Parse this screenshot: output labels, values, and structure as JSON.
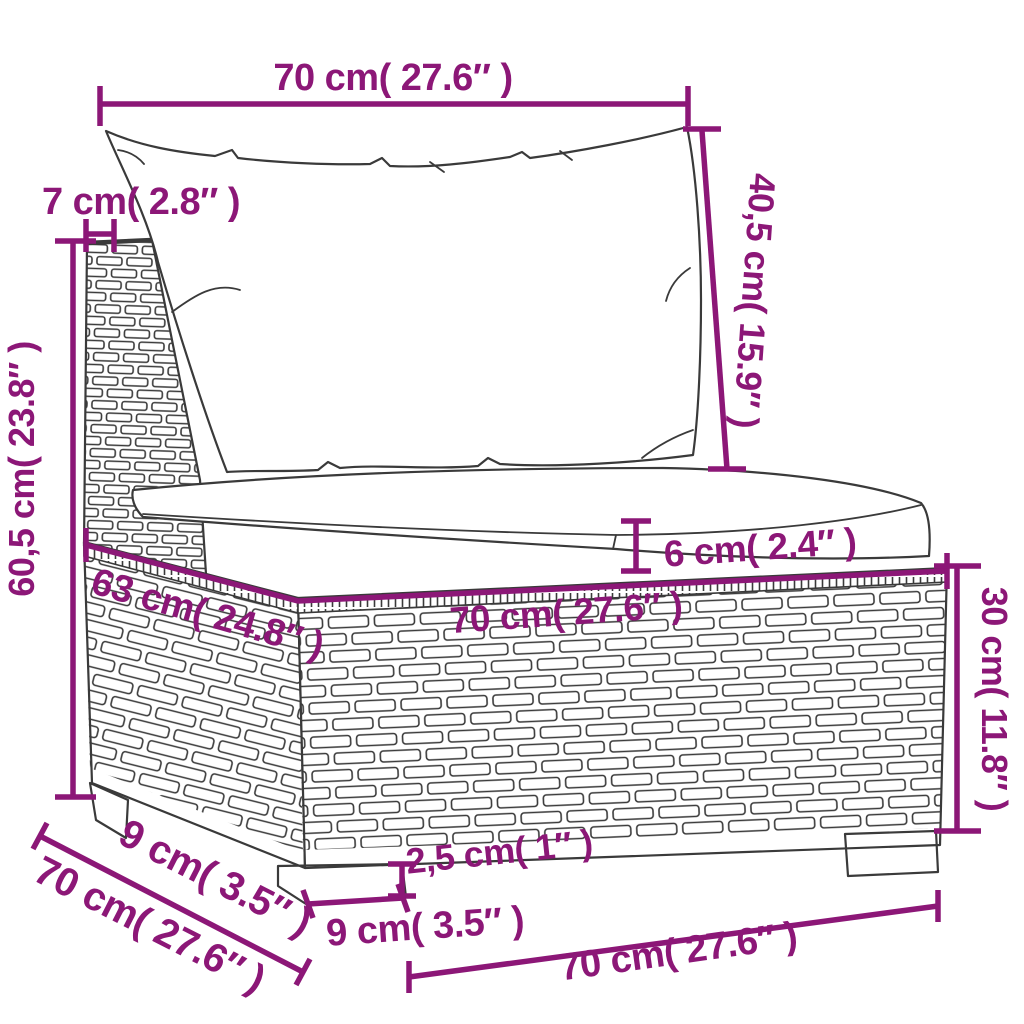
{
  "diagram": {
    "subject": "sectional-sofa-middle-seat-dimension-drawing",
    "colors": {
      "accent": "#8C1777",
      "line": "#3A3A3A",
      "background": "#FFFFFF"
    }
  },
  "labels": {
    "top_width": "70 cm( 27.6″ )",
    "back_depth": "7 cm( 2.8″ )",
    "back_height": "40,5 cm( 15.9″ )",
    "total_height": "60,5 cm( 23.8″ )",
    "cushion_thickness": "6 cm( 2.4″ )",
    "seat_width": "70 cm( 27.6″ )",
    "seat_depth": "63 cm( 24.8″ )",
    "base_height": "30 cm( 11.8″ )",
    "foot_height": "2,5 cm( 1″ )",
    "foot_width": "9 cm( 3.5″ )",
    "side_offset": "9 cm( 3.5″ )",
    "unit_depth": "70 cm( 27.6″ )",
    "bottom_width": "70 cm( 27.6″ )"
  }
}
